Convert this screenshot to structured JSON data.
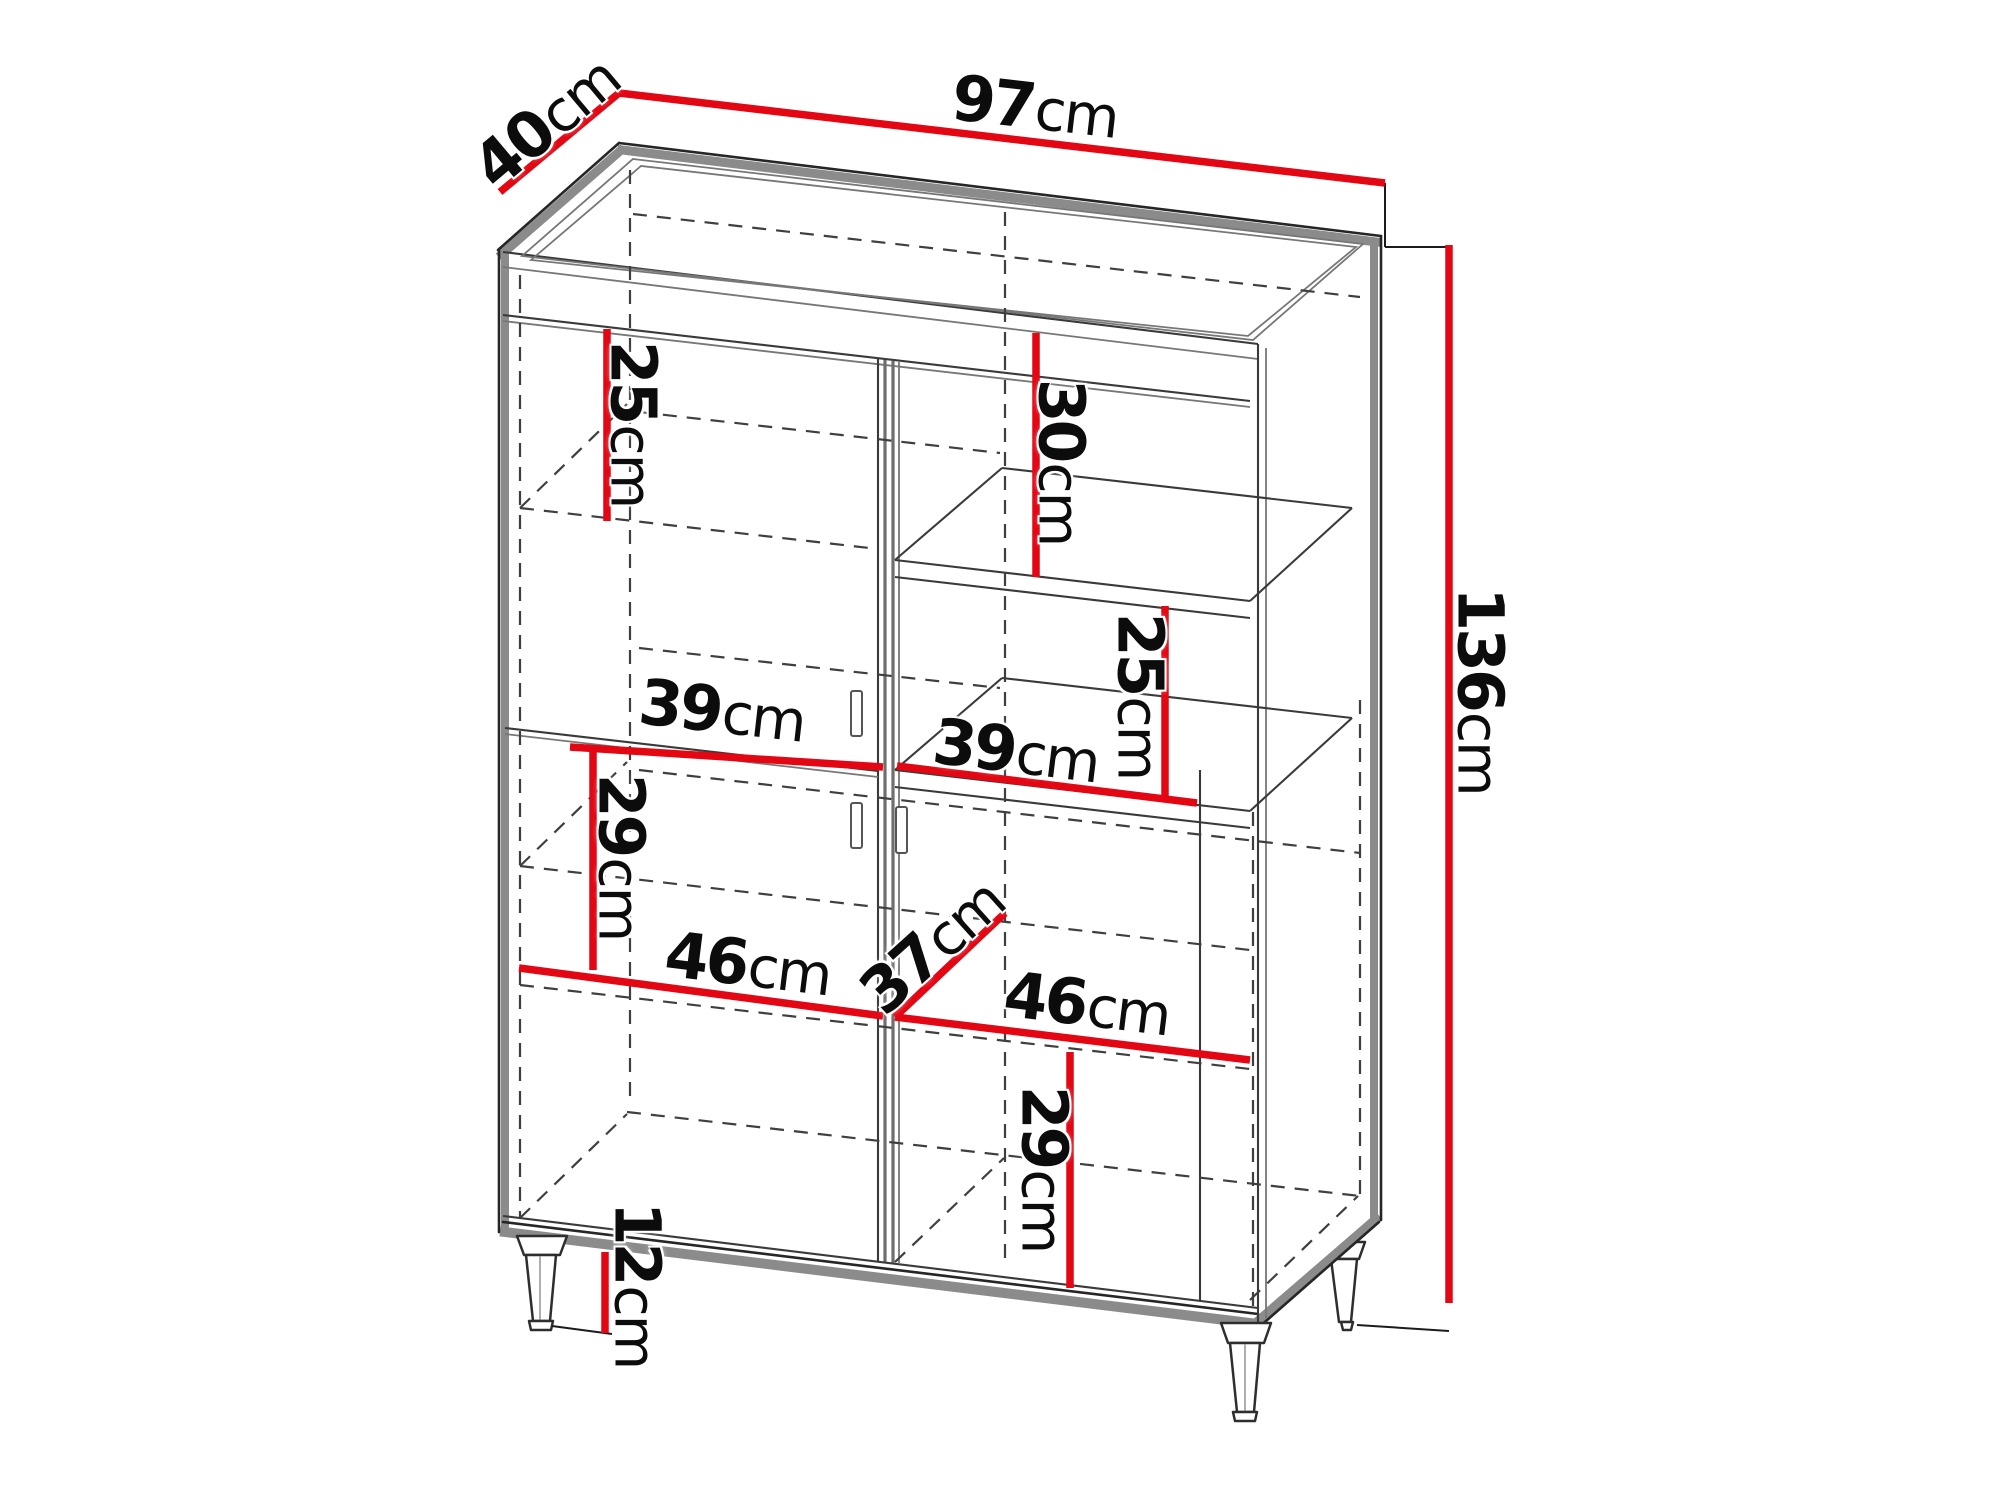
{
  "diagram": {
    "type": "furniture-dimension-drawing",
    "subject": "two-door display cabinet with open shelves and legs",
    "units": "cm",
    "accent_color": "#e30613",
    "line_color": "#262626",
    "overall": {
      "width_label": "97cm",
      "depth_label": "40cm",
      "height_label": "136cm"
    },
    "dimensions": [
      {
        "id": "overall-width",
        "value": "97",
        "unit": "cm"
      },
      {
        "id": "overall-depth",
        "value": "40",
        "unit": "cm"
      },
      {
        "id": "overall-height",
        "value": "136",
        "unit": "cm"
      },
      {
        "id": "top-left-compartment-height",
        "value": "25",
        "unit": "cm"
      },
      {
        "id": "top-right-compartment-height",
        "value": "30",
        "unit": "cm"
      },
      {
        "id": "right-shelf-height",
        "value": "25",
        "unit": "cm"
      },
      {
        "id": "left-compartment-width",
        "value": "39",
        "unit": "cm"
      },
      {
        "id": "right-compartment-width",
        "value": "39",
        "unit": "cm"
      },
      {
        "id": "left-middle-height",
        "value": "29",
        "unit": "cm"
      },
      {
        "id": "left-lower-width",
        "value": "46",
        "unit": "cm"
      },
      {
        "id": "interior-depth",
        "value": "37",
        "unit": "cm"
      },
      {
        "id": "right-lower-width",
        "value": "46",
        "unit": "cm"
      },
      {
        "id": "right-lower-height",
        "value": "29",
        "unit": "cm"
      },
      {
        "id": "leg-height",
        "value": "12",
        "unit": "cm"
      }
    ]
  }
}
